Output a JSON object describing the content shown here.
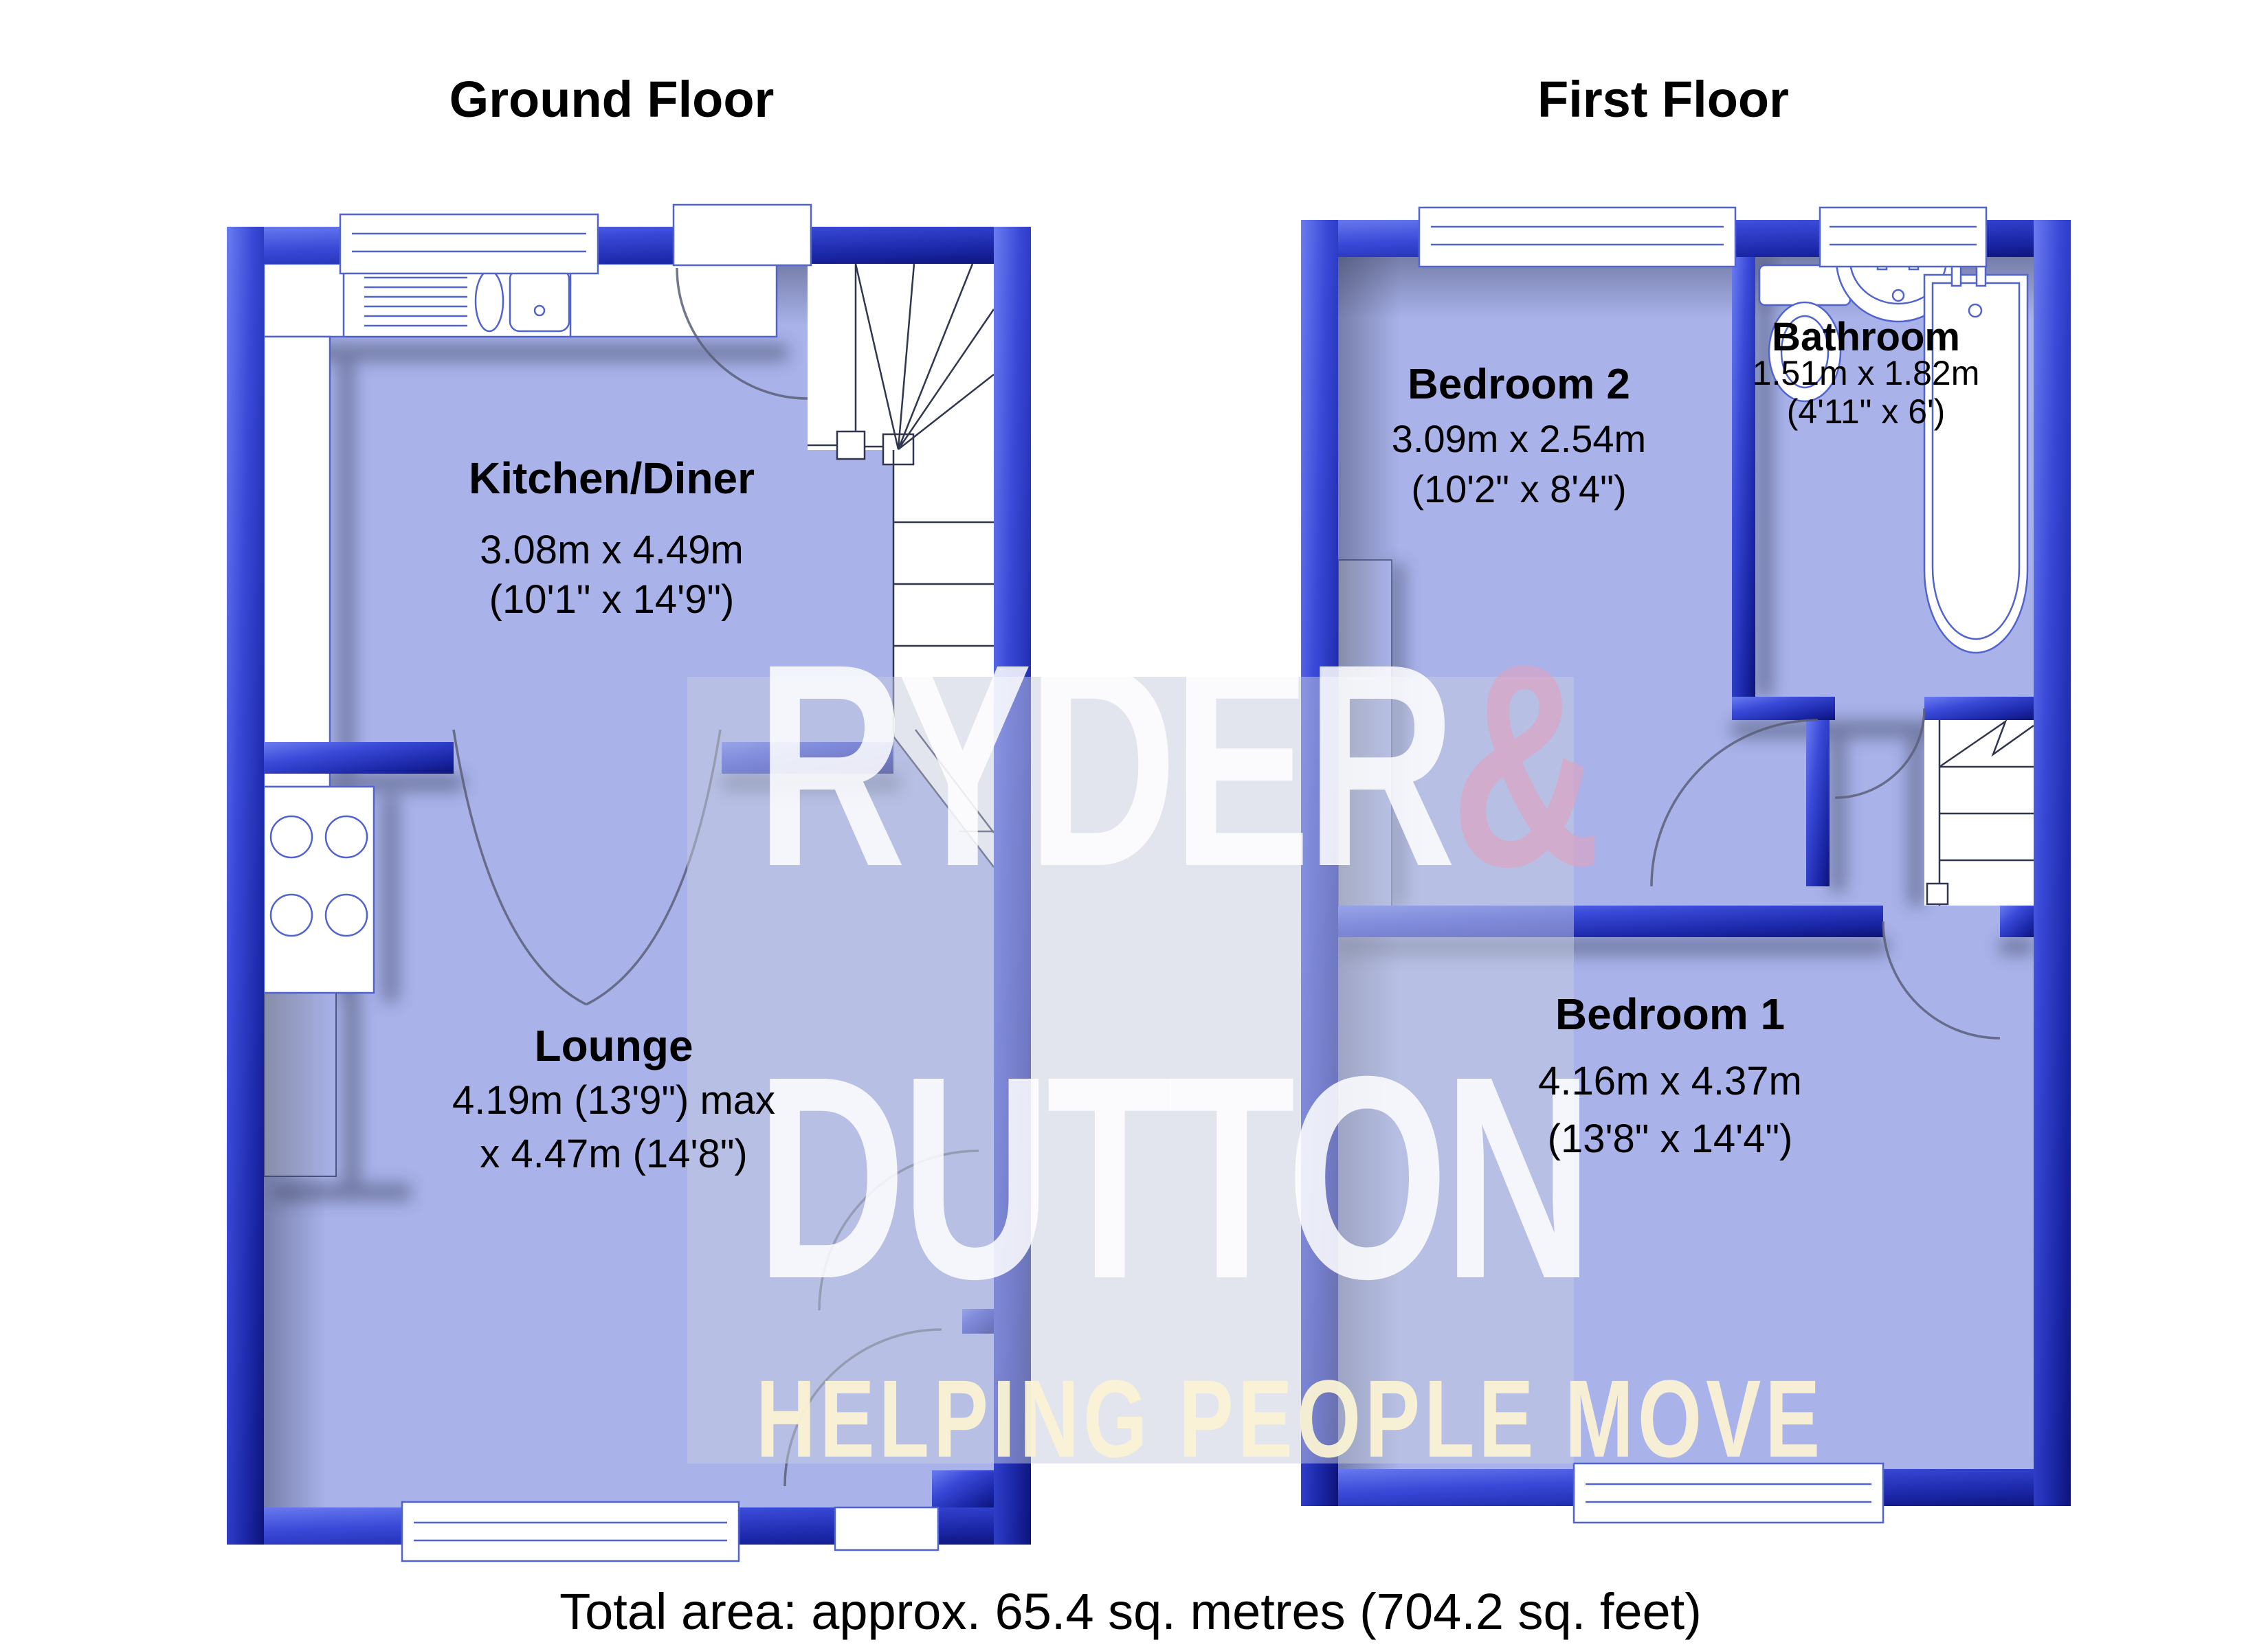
{
  "floors": [
    {
      "id": "ground",
      "title": "Ground Floor",
      "rooms": [
        {
          "name": "Kitchen/Diner",
          "dim_metric": "3.08m x 4.49m",
          "dim_imperial": "(10'1\" x 14'9\")"
        },
        {
          "name": "Lounge",
          "dim_metric": "4.19m (13'9\") max",
          "dim_imperial": "x 4.47m (14'8\")"
        }
      ]
    },
    {
      "id": "first",
      "title": "First Floor",
      "rooms": [
        {
          "name": "Bedroom 2",
          "dim_metric": "3.09m x 2.54m",
          "dim_imperial": "(10'2\" x 8'4\")"
        },
        {
          "name": "Bathroom",
          "dim_metric": "1.51m x 1.82m",
          "dim_imperial": "(4'11\" x 6')"
        },
        {
          "name": "Bedroom 1",
          "dim_metric": "4.16m x 4.37m",
          "dim_imperial": "(13'8\" x 14'4\")"
        }
      ]
    }
  ],
  "watermark": {
    "line1": "RYDER",
    "amp": "&",
    "line2": "DUTTON",
    "tagline": "HELPING PEOPLE MOVE"
  },
  "footer": {
    "total_area": "Total area: approx. 65.4 sq. metres (704.2 sq. feet)"
  },
  "colors": {
    "wall_blue": "#3445d2",
    "wall_dark": "#0d1478",
    "room_fill": "#a9b3ea",
    "fixture_outline": "#5063cf",
    "watermark_pink": "#e2a0bc",
    "watermark_cream": "#faf2d4"
  }
}
